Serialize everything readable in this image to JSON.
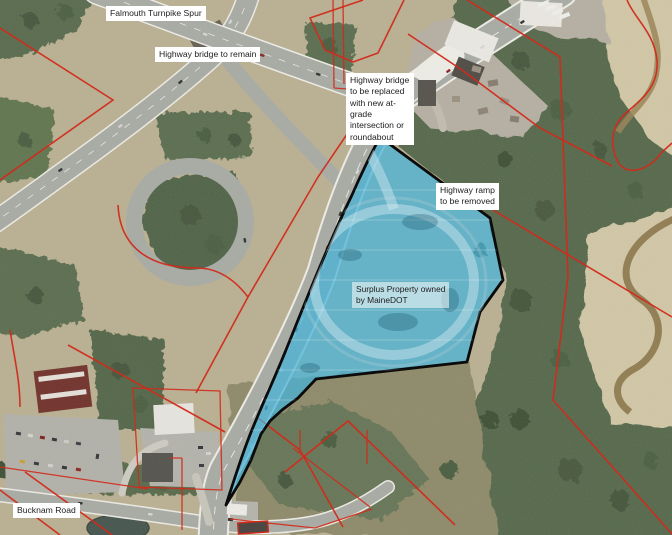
{
  "figure": {
    "type": "annotated-aerial-map",
    "labels": {
      "falmouth_spur": "Falmouth Turnpike Spur",
      "bridge_remain": "Highway bridge to remain",
      "bridge_replace": "Highway bridge\nto be replaced\nwith new at-\ngrade\nintersection or\nroundabout",
      "ramp_remove": "Highway ramp\nto be removed",
      "surplus_property": "Surplus Property owned\nby MaineDOT",
      "bucknam_road": "Bucknam Road"
    },
    "colors": {
      "parcel_line_red": "#d22a1a",
      "property_fill_blue": "#45b3da",
      "property_outline_black": "#0b0b0b",
      "label_background": "#ffffff",
      "label_text": "#1c1c1c"
    }
  }
}
